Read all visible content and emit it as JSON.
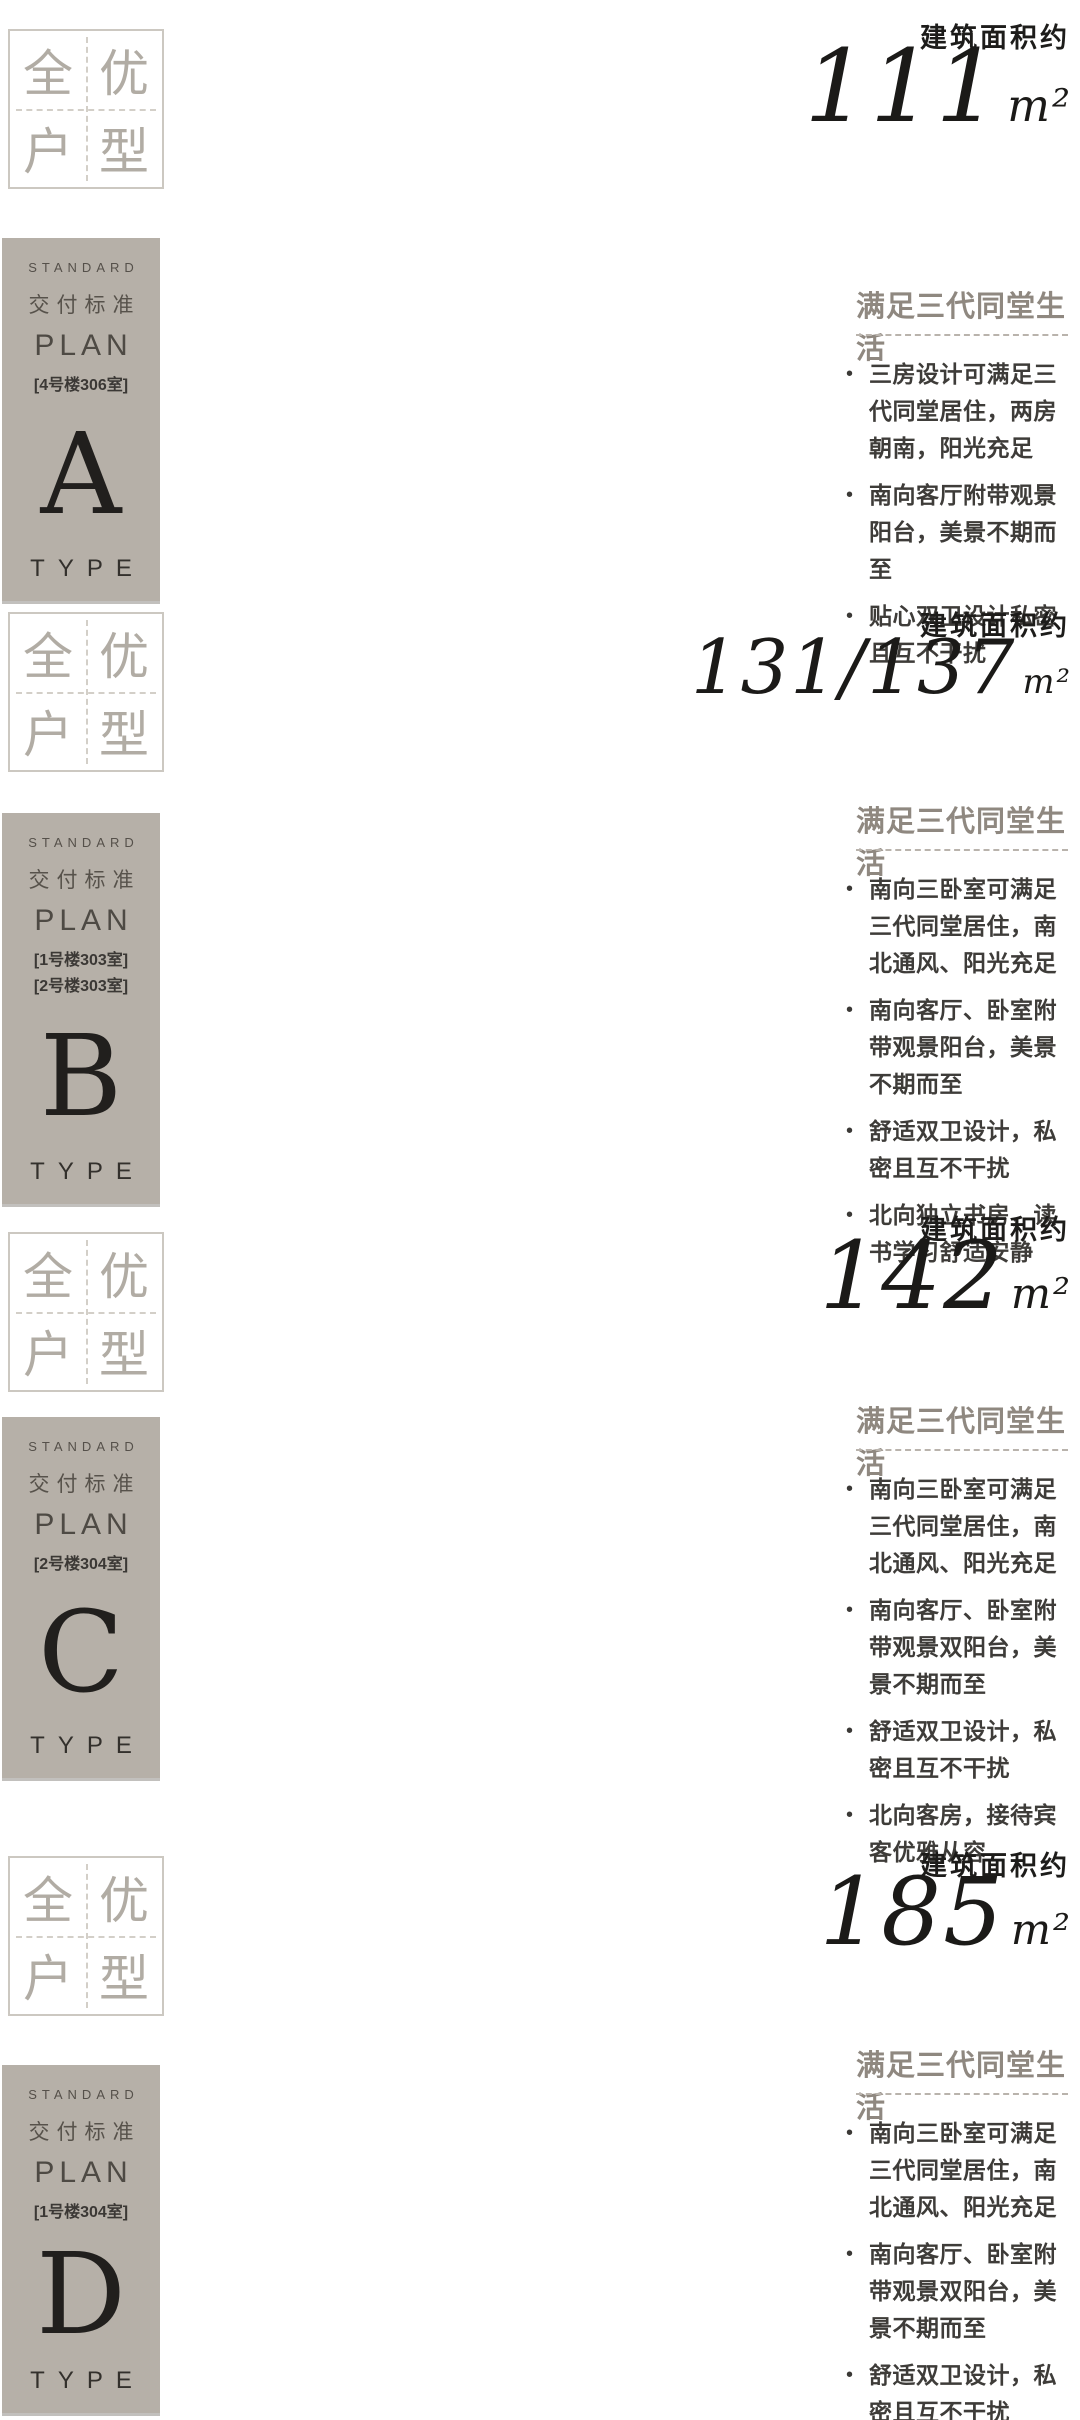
{
  "badge": {
    "chars": [
      "全",
      "优",
      "户",
      "型"
    ]
  },
  "panel": {
    "standard": "STANDARD",
    "delivery": "交付标准",
    "plan": "PLAN",
    "type": "TYPE"
  },
  "bullet_char": "•",
  "legend": {
    "delivered": "交付标准收纳",
    "not_delivered": "非交付标准收纳",
    "delivered_color": "#ddc27a",
    "not_delivered_color": "#6fa9bd"
  },
  "plan_colors": {
    "wall": "#b2b2b2",
    "inner": "#c9c9c9",
    "room_text": "#8f8f8f",
    "flow": "#a9c4de",
    "sun": "#e3cb80",
    "teal": "#6fa9bd",
    "yellow": "#ddc27a",
    "tri": "#a39384",
    "legend_text": "#9a948c"
  },
  "sections": [
    {
      "letter": "A",
      "rooms_lines": [
        "[4号楼306室]"
      ],
      "area_label": "建筑面积约",
      "area_value": "111",
      "area_unit": "m²",
      "rp_title": "满足三代同堂生活",
      "bullets": [
        "三房设计可满足三代同堂居住，两房朝南，阳光充足",
        "南向客厅附带观景阳台，美景不期而至",
        "贴心双卫设计私密且互不干扰"
      ],
      "plan": {
        "vb": [
          640,
          585
        ],
        "outline": "M300 14 L557 14 L557 452 L228 452 L228 421 L96 421 L96 76 L300 76 Z",
        "walls": [
          [
            96,
            200,
            330,
            200
          ],
          [
            330,
            14,
            330,
            200
          ],
          [
            460,
            14,
            460,
            112
          ],
          [
            330,
            112,
            557,
            112
          ],
          [
            180,
            76,
            180,
            200
          ],
          [
            270,
            76,
            270,
            200
          ],
          [
            96,
            253,
            225,
            253
          ],
          [
            225,
            253,
            225,
            421
          ],
          [
            338,
            253,
            338,
            421
          ],
          [
            338,
            253,
            557,
            253
          ],
          [
            228,
            421,
            557,
            421
          ]
        ],
        "storages": [
          [
            168,
            168,
            50,
            26,
            "t"
          ],
          [
            100,
            205,
            66,
            60,
            "t"
          ],
          [
            272,
            244,
            52,
            26,
            "t"
          ],
          [
            398,
            24,
            16,
            46,
            "y"
          ]
        ],
        "rooms": [
          [
            "北次卧",
            218,
            118
          ],
          [
            "淋浴间",
            287,
            100
          ],
          [
            "主卫",
            140,
            152
          ],
          [
            "次卫",
            283,
            152
          ],
          [
            "厨房",
            372,
            72
          ],
          [
            "玄关",
            432,
            75
          ],
          [
            "餐厅",
            357,
            170
          ],
          [
            "主卧",
            152,
            325
          ],
          [
            "南次卧",
            292,
            332
          ],
          [
            "客厅",
            398,
            312
          ],
          [
            "阳台",
            390,
            437
          ],
          [
            "飘窗",
            158,
            400
          ]
        ],
        "flows": [
          "M132 505 C150 420 118 330 138 240 C155 165 128 90 138 38",
          "M218 500 C200 420 240 330 218 240 C205 165 228 90 220 30",
          "M292 505 C310 430 275 340 295 250 C312 175 285 100 293 35",
          "M505 470 C515 390 490 320 505 240 C515 180 498 120 505 60",
          "M430 40 C415 130 455 230 432 320 C418 395 442 450 432 505"
        ],
        "suns": [
          [
            150,
            560,
            163,
            495
          ],
          [
            172,
            552,
            185,
            487
          ],
          [
            194,
            545,
            207,
            480
          ],
          [
            258,
            538,
            271,
            473
          ],
          [
            280,
            531,
            293,
            466
          ],
          [
            302,
            524,
            315,
            459
          ],
          [
            352,
            528,
            365,
            463
          ],
          [
            374,
            521,
            387,
            456
          ],
          [
            396,
            514,
            409,
            449
          ]
        ],
        "tri": "433,4 457,4 445,24",
        "legend": [
          470,
          518
        ],
        "north": [
          614,
          512
        ]
      }
    },
    {
      "letter": "B",
      "rooms_lines": [
        "[1号楼303室]",
        "[2号楼303室]"
      ],
      "area_label": "建筑面积约",
      "area_value": "131/137",
      "area_unit": "m²",
      "rp_title": "满足三代同堂生活",
      "bullets": [
        "南向三卧室可满足三代同堂居住，南北通风、阳光充足",
        "南向客厅、卧室附带观景阳台，美景不期而至",
        "舒适双卫设计，私密且互不干扰",
        "北向独立书房，读书学习舒适安静"
      ],
      "plan": {
        "vb": [
          640,
          585
        ],
        "outline": "M167 42 L480 42 L480 150 L500 150 L500 360 L480 360 L480 386 L385 386 L385 421 L150 421 L150 386 L35 386 L35 200 L167 200 Z",
        "walls": [
          [
            167,
            150,
            480,
            150
          ],
          [
            255,
            42,
            255,
            150
          ],
          [
            330,
            42,
            330,
            150
          ],
          [
            380,
            42,
            380,
            150
          ],
          [
            410,
            150,
            410,
            386
          ],
          [
            148,
            230,
            148,
            386
          ],
          [
            282,
            230,
            282,
            386
          ],
          [
            35,
            230,
            148,
            230
          ],
          [
            282,
            230,
            410,
            230
          ],
          [
            150,
            386,
            385,
            386
          ]
        ],
        "storages": [
          [
            48,
            206,
            64,
            24,
            "t"
          ],
          [
            120,
            206,
            40,
            18,
            "y"
          ],
          [
            284,
            208,
            56,
            18,
            "y"
          ],
          [
            284,
            230,
            56,
            24,
            "t"
          ],
          [
            424,
            214,
            66,
            24,
            "t"
          ]
        ],
        "rooms": [
          [
            "餐厅",
            213,
            108
          ],
          [
            "厨房",
            283,
            108
          ],
          [
            "淋浴间",
            352,
            66
          ],
          [
            "书房",
            438,
            95
          ],
          [
            "玄关",
            143,
            172
          ],
          [
            "客卫",
            352,
            120
          ],
          [
            "主卫",
            442,
            185
          ],
          [
            "客卧",
            92,
            295
          ],
          [
            "客厅",
            222,
            280
          ],
          [
            "南次卧",
            330,
            300
          ],
          [
            "主卧",
            452,
            295
          ],
          [
            "阳台",
            262,
            404
          ],
          [
            "飘窗",
            90,
            400
          ],
          [
            "飘窗",
            452,
            374
          ]
        ],
        "flows": [
          "M230 22 C215 110 255 200 232 290 C218 360 240 430 230 500",
          "M360 18 C345 100 385 190 362 280 C350 350 372 420 362 495",
          "M98 468 C108 400 90 340 100 272"
        ],
        "suns": [
          [
            70,
            545,
            83,
            480
          ],
          [
            92,
            537,
            105,
            472
          ],
          [
            114,
            529,
            127,
            464
          ],
          [
            185,
            523,
            198,
            458
          ],
          [
            207,
            515,
            220,
            450
          ],
          [
            229,
            507,
            242,
            442
          ],
          [
            300,
            523,
            313,
            458
          ],
          [
            322,
            515,
            335,
            450
          ],
          [
            344,
            507,
            357,
            442
          ],
          [
            415,
            530,
            428,
            465
          ],
          [
            437,
            522,
            450,
            457
          ],
          [
            459,
            514,
            472,
            449
          ]
        ],
        "tri": "145,92 169,92 157,112",
        "legend": [
          375,
          458
        ],
        "north": [
          485,
          418
        ]
      }
    },
    {
      "letter": "C",
      "rooms_lines": [
        "[2号楼304室]"
      ],
      "area_label": "建筑面积约",
      "area_value": "142",
      "area_unit": "m²",
      "rp_title": "满足三代同堂生活",
      "bullets": [
        "南向三卧室可满足三代同堂居住，南北通风、阳光充足",
        "南向客厅、卧室附带观景双阳台，美景不期而至",
        "舒适双卫设计，私密且互不干扰",
        "北向客房，接待宾客优雅从容"
      ],
      "plan": {
        "vb": [
          680,
          605
        ],
        "outline": "M40 45 L620 45 L620 390 L555 390 L555 425 L330 425 L330 390 L285 390 L285 425 L75 425 L75 390 L40 390 Z",
        "walls": [
          [
            40,
            160,
            620,
            160
          ],
          [
            130,
            45,
            130,
            160
          ],
          [
            215,
            45,
            215,
            160
          ],
          [
            290,
            45,
            290,
            160
          ],
          [
            370,
            45,
            370,
            160
          ],
          [
            480,
            45,
            480,
            160
          ],
          [
            180,
            160,
            180,
            390
          ],
          [
            330,
            160,
            330,
            390
          ],
          [
            500,
            160,
            500,
            390
          ]
        ],
        "storages": [
          [
            55,
            168,
            66,
            24,
            "t"
          ],
          [
            195,
            188,
            56,
            24,
            "t"
          ],
          [
            200,
            168,
            50,
            16,
            "y"
          ],
          [
            470,
            168,
            66,
            24,
            "t"
          ],
          [
            560,
            60,
            16,
            44,
            "y"
          ]
        ],
        "rooms": [
          [
            "主卫",
            82,
            95
          ],
          [
            "北次卧",
            172,
            100
          ],
          [
            "淋浴间",
            250,
            64
          ],
          [
            "厨房",
            305,
            95
          ],
          [
            "餐厅",
            420,
            130
          ],
          [
            "玄关",
            545,
            95
          ],
          [
            "主卧",
            110,
            300
          ],
          [
            "南次卧",
            255,
            305
          ],
          [
            "客厅",
            420,
            290
          ],
          [
            "客卧",
            560,
            305
          ],
          [
            "阳台",
            170,
            408
          ],
          [
            "阳台",
            440,
            408
          ],
          [
            "飘窗",
            82,
            372
          ],
          [
            "飘窗",
            600,
            372
          ]
        ],
        "flows": [
          "M210 25 C195 110 235 200 212 290 C200 360 222 430 212 505",
          "M350 22 C335 105 375 195 352 285 C340 355 362 425 352 500",
          "M520 25 C505 110 545 200 522 290 C510 360 532 430 522 505"
        ],
        "suns": [
          [
            105,
            548,
            118,
            483
          ],
          [
            127,
            540,
            140,
            475
          ],
          [
            149,
            532,
            162,
            467
          ],
          [
            245,
            543,
            258,
            478
          ],
          [
            267,
            535,
            280,
            470
          ],
          [
            289,
            527,
            302,
            462
          ],
          [
            395,
            543,
            408,
            478
          ],
          [
            417,
            535,
            430,
            470
          ],
          [
            439,
            527,
            452,
            462
          ],
          [
            520,
            548,
            533,
            483
          ],
          [
            542,
            540,
            555,
            475
          ],
          [
            564,
            532,
            577,
            467
          ]
        ],
        "tri": "598,55 622,55 610,75",
        "legend": [
          505,
          518
        ],
        "north": [
          645,
          500
        ]
      }
    },
    {
      "letter": "D",
      "rooms_lines": [
        "[1号楼304室]"
      ],
      "area_label": "建筑面积约",
      "area_value": "185",
      "area_unit": "m²",
      "rp_title": "满足三代同堂生活",
      "bullets": [
        "南向三卧室可满足三代同堂居住，南北通风、阳光充足",
        "南向客厅、卧室附带观景双阳台，美景不期而至",
        "舒适双卫设计，私密且互不干扰",
        "北向客房，接待宾客优雅从容"
      ],
      "plan": {
        "vb": [
          645,
          580
        ],
        "outline": "M150 6 L390 6 L390 70 L520 70 L520 420 L365 420 L365 455 L145 455 L145 420 L125 420 L125 450 L85 450 L85 125 L125 125 L125 105 L150 105 Z",
        "walls": [
          [
            150,
            105,
            390,
            105
          ],
          [
            230,
            6,
            230,
            105
          ],
          [
            310,
            6,
            310,
            105
          ],
          [
            125,
            190,
            365,
            190
          ],
          [
            365,
            70,
            365,
            265
          ],
          [
            265,
            255,
            265,
            420
          ],
          [
            365,
            265,
            520,
            265
          ],
          [
            450,
            265,
            450,
            420
          ],
          [
            145,
            420,
            365,
            420
          ],
          [
            125,
            125,
            125,
            420
          ]
        ],
        "storages": [
          [
            205,
            86,
            52,
            20,
            "t"
          ],
          [
            372,
            8,
            16,
            58,
            "t"
          ],
          [
            372,
            78,
            18,
            64,
            "y"
          ],
          [
            370,
            152,
            44,
            18,
            "y"
          ],
          [
            370,
            218,
            44,
            14,
            "y"
          ],
          [
            160,
            205,
            30,
            36,
            "t"
          ],
          [
            270,
            272,
            50,
            20,
            "t"
          ],
          [
            408,
            232,
            52,
            20,
            "t"
          ]
        ],
        "rooms": [
          [
            "次卫",
            185,
            55
          ],
          [
            "北次卧",
            262,
            40
          ],
          [
            "书房",
            348,
            48
          ],
          [
            "厨房",
            215,
            155
          ],
          [
            "外卫",
            305,
            150
          ],
          [
            "玄关",
            392,
            200
          ],
          [
            "餐厅",
            210,
            225
          ],
          [
            "儿童区",
            288,
            240
          ],
          [
            "客厅",
            200,
            325
          ],
          [
            "南次卧",
            318,
            350
          ],
          [
            "主卧",
            425,
            352
          ],
          [
            "主卫",
            500,
            308
          ],
          [
            "淋浴间",
            497,
            352
          ],
          [
            "阳台",
            104,
            325
          ],
          [
            "阳台",
            230,
            440
          ],
          [
            "飘窗",
            425,
            408
          ],
          [
            "飘窗",
            505,
            408
          ]
        ],
        "flows": [
          "M305 10 C290 90 330 170 305 250 C285 330 230 390 185 470",
          "M330 60 C318 140 350 220 330 300 C318 370 340 430 330 505",
          "M98 250 C112 300 90 350 105 400"
        ],
        "suns": [
          [
            55,
            262,
            118,
            245
          ],
          [
            55,
            287,
            118,
            270
          ],
          [
            55,
            312,
            118,
            295
          ],
          [
            178,
            510,
            192,
            442
          ],
          [
            200,
            503,
            214,
            435
          ],
          [
            222,
            496,
            236,
            428
          ],
          [
            295,
            510,
            309,
            442
          ],
          [
            317,
            503,
            331,
            435
          ],
          [
            339,
            496,
            353,
            428
          ],
          [
            408,
            505,
            422,
            437
          ],
          [
            430,
            498,
            444,
            430
          ],
          [
            452,
            491,
            466,
            423
          ]
        ],
        "tri": "448,185 468,173 468,197",
        "legend": [
          478,
          512
        ],
        "north": [
          560,
          495
        ]
      }
    }
  ]
}
